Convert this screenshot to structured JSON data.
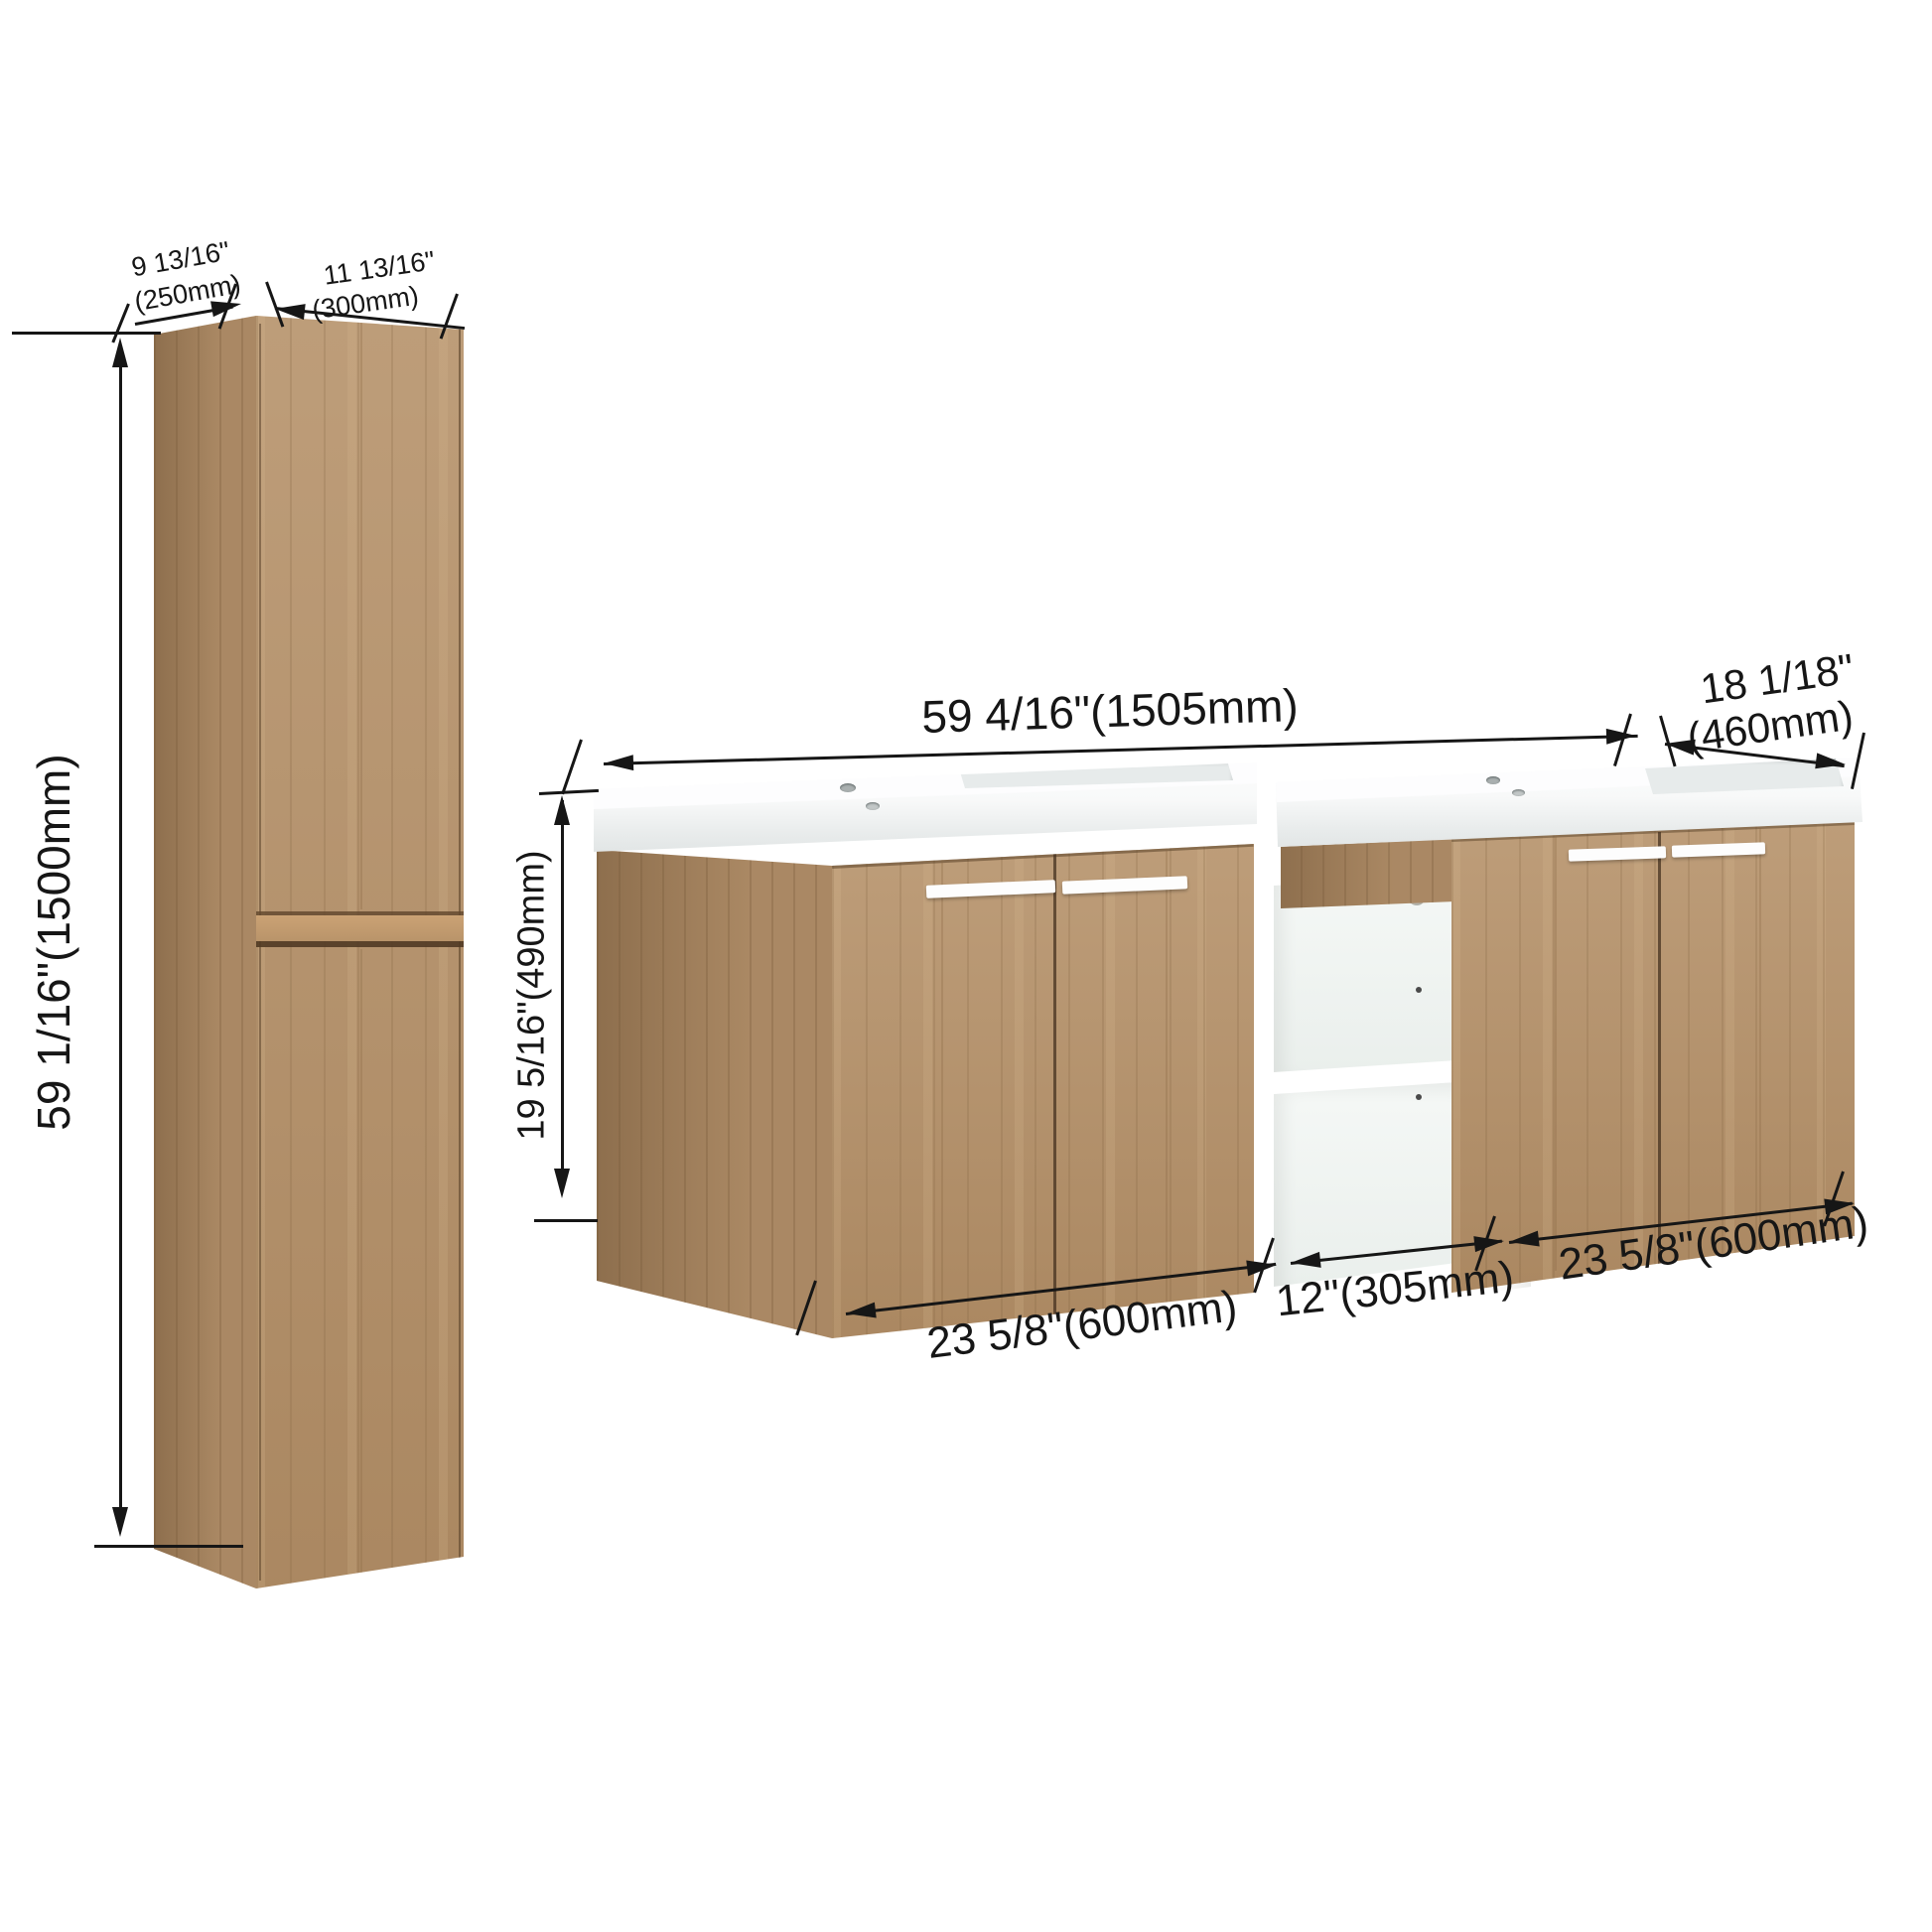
{
  "tall_cabinet": {
    "depth_in": "9 13/16\"",
    "depth_mm": "(250mm)",
    "width_in": "11 13/16\"",
    "width_mm": "(300mm)",
    "height": "59 1/16\"(1500mm)"
  },
  "vanity": {
    "overall_width": "59 4/16\"(1505mm)",
    "depth_in": "18 1/18\"",
    "depth_mm": "(460mm)",
    "height": "19 5/16\"(490mm)",
    "left_width": "23 5/8\"(600mm)",
    "shelf_width": "12\"(305mm)",
    "right_width": "23 5/8\"(600mm)"
  },
  "colors": {
    "wood_front": "#b6926a",
    "wood_side": "#a5815a",
    "shelf_white": "#ffffff",
    "line": "#161616"
  }
}
